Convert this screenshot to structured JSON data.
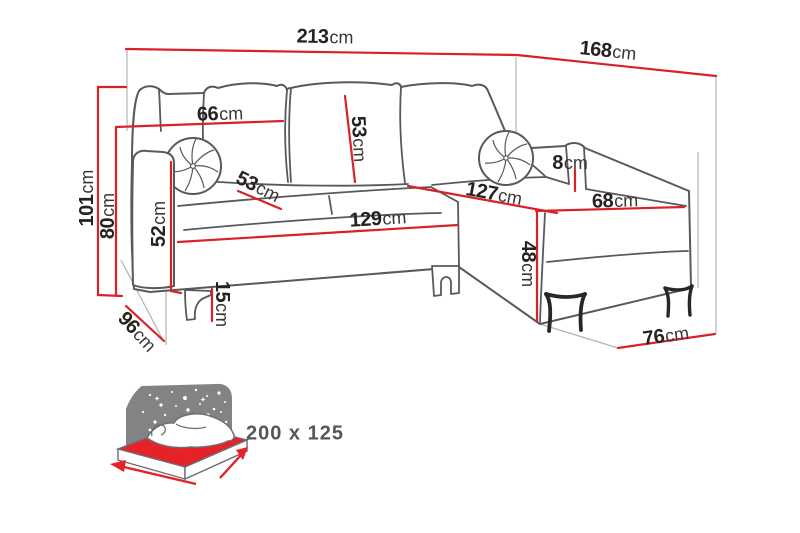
{
  "diagram": {
    "product": "corner-sofa-dimension-diagram",
    "dimensions": {
      "total_width": {
        "value": "213",
        "unit": "cm"
      },
      "total_depth": {
        "value": "168",
        "unit": "cm"
      },
      "total_height": {
        "value": "101",
        "unit": "cm"
      },
      "backrest_height": {
        "value": "80",
        "unit": "cm"
      },
      "back_cushion_width": {
        "value": "66",
        "unit": "cm"
      },
      "back_cushion_height": {
        "value": "53",
        "unit": "cm"
      },
      "seat_depth": {
        "value": "53",
        "unit": "cm"
      },
      "armrest_height": {
        "value": "52",
        "unit": "cm"
      },
      "seat_length": {
        "value": "129",
        "unit": "cm"
      },
      "chaise_length": {
        "value": "127",
        "unit": "cm"
      },
      "chaise_width": {
        "value": "68",
        "unit": "cm"
      },
      "side_trim_width": {
        "value": "8",
        "unit": "cm"
      },
      "seat_height": {
        "value": "48",
        "unit": "cm"
      },
      "leg_height": {
        "value": "15",
        "unit": "cm"
      },
      "side_depth": {
        "value": "96",
        "unit": "cm"
      },
      "chaise_front_width": {
        "value": "76",
        "unit": "cm"
      }
    },
    "sleeping_area": {
      "size_label": "200 x 125"
    },
    "icons": {
      "sofa_bed_icon": "sofa-bed-with-fold-out-mattress"
    },
    "colors": {
      "dimension_line": "#d92127",
      "outline": "#58595b",
      "guide_line": "#b2b4b6",
      "icon_panel_gray": "#818385",
      "mattress_red": "#e52228",
      "label_text": "#26221f",
      "size_text": "#55565a"
    }
  }
}
